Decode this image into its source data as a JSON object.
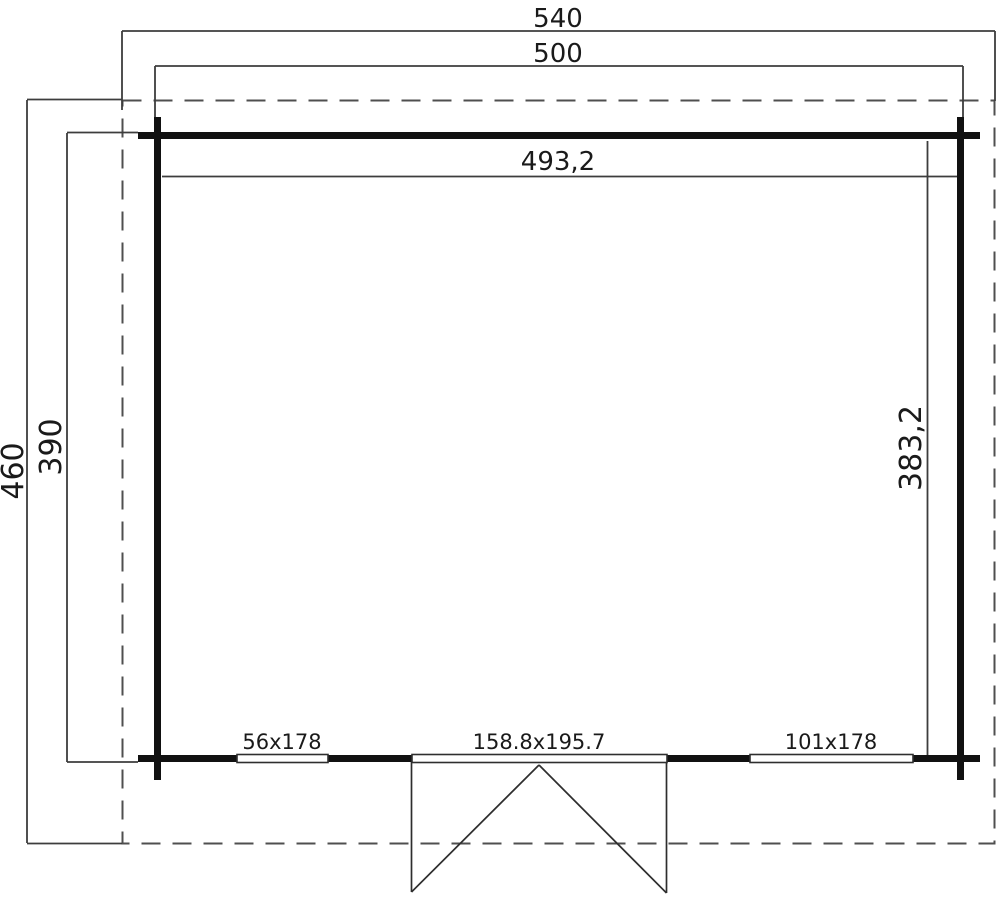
{
  "drawing": {
    "type": "floor-plan",
    "dimensions": {
      "roof_width": "540",
      "outer_width": "500",
      "inner_width": "493,2",
      "roof_depth": "460",
      "outer_depth": "390",
      "inner_depth": "383,2"
    },
    "openings": {
      "left_window": "56x178",
      "door": "158.8x195.7",
      "right_window": "101x178"
    },
    "colors": {
      "wall": "#111111",
      "thin_line": "#3d3d3d",
      "dashed_line": "#4f4f4f",
      "text": "#1a1a1a",
      "background": "#ffffff"
    }
  }
}
